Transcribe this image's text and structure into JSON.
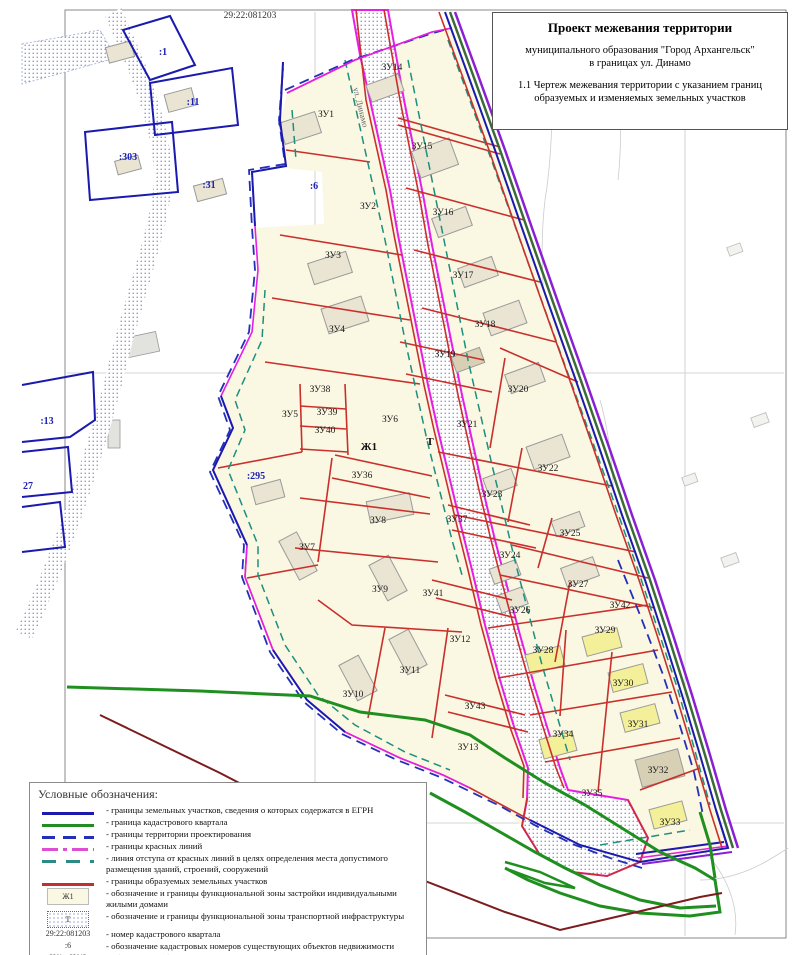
{
  "title_block": {
    "line1": "Проект межевания территории",
    "line2": "муниципального образования \"Город Архангельск\"",
    "line3": "в границах ул. Динамо",
    "line4": "1.1 Чертеж межевания территории с указанием границ образуемых и изменяемых земельных участков"
  },
  "map": {
    "quarter_number": "29:22:081203",
    "street_label": "ул. Динамо",
    "zone_labels": [
      {
        "t": "Ж1",
        "x": 369,
        "y": 450
      },
      {
        "t": "Т",
        "x": 430,
        "y": 445
      }
    ],
    "plot_labels": [
      {
        "t": "ЗУ1",
        "x": 326,
        "y": 117
      },
      {
        "t": "ЗУ2",
        "x": 368,
        "y": 209
      },
      {
        "t": "ЗУ3",
        "x": 333,
        "y": 258
      },
      {
        "t": "ЗУ4",
        "x": 337,
        "y": 332
      },
      {
        "t": "ЗУ5",
        "x": 290,
        "y": 417
      },
      {
        "t": "ЗУ6",
        "x": 390,
        "y": 422
      },
      {
        "t": "ЗУ7",
        "x": 307,
        "y": 550
      },
      {
        "t": "ЗУ8",
        "x": 378,
        "y": 523
      },
      {
        "t": "ЗУ9",
        "x": 380,
        "y": 592
      },
      {
        "t": "ЗУ10",
        "x": 353,
        "y": 697
      },
      {
        "t": "ЗУ11",
        "x": 410,
        "y": 673
      },
      {
        "t": "ЗУ12",
        "x": 460,
        "y": 642
      },
      {
        "t": "ЗУ13",
        "x": 468,
        "y": 750
      },
      {
        "t": "ЗУ14",
        "x": 392,
        "y": 70
      },
      {
        "t": "ЗУ15",
        "x": 422,
        "y": 149
      },
      {
        "t": "ЗУ16",
        "x": 443,
        "y": 215
      },
      {
        "t": "ЗУ17",
        "x": 463,
        "y": 278
      },
      {
        "t": "ЗУ18",
        "x": 485,
        "y": 327
      },
      {
        "t": "ЗУ19",
        "x": 445,
        "y": 357
      },
      {
        "t": "ЗУ20",
        "x": 518,
        "y": 392
      },
      {
        "t": "ЗУ21",
        "x": 467,
        "y": 427
      },
      {
        "t": "ЗУ22",
        "x": 548,
        "y": 471
      },
      {
        "t": "ЗУ23",
        "x": 492,
        "y": 497
      },
      {
        "t": "ЗУ24",
        "x": 510,
        "y": 558
      },
      {
        "t": "ЗУ25",
        "x": 570,
        "y": 536
      },
      {
        "t": "ЗУ26",
        "x": 520,
        "y": 613
      },
      {
        "t": "ЗУ27",
        "x": 578,
        "y": 587
      },
      {
        "t": "ЗУ28",
        "x": 543,
        "y": 653
      },
      {
        "t": "ЗУ29",
        "x": 605,
        "y": 633
      },
      {
        "t": "ЗУ30",
        "x": 623,
        "y": 686
      },
      {
        "t": "ЗУ31",
        "x": 638,
        "y": 727
      },
      {
        "t": "ЗУ32",
        "x": 658,
        "y": 773
      },
      {
        "t": "ЗУ33",
        "x": 670,
        "y": 825
      },
      {
        "t": "ЗУ34",
        "x": 563,
        "y": 737
      },
      {
        "t": "ЗУ35",
        "x": 592,
        "y": 796
      },
      {
        "t": "ЗУ36",
        "x": 362,
        "y": 478
      },
      {
        "t": "ЗУ37",
        "x": 457,
        "y": 522
      },
      {
        "t": "ЗУ38",
        "x": 320,
        "y": 392
      },
      {
        "t": "ЗУ39",
        "x": 327,
        "y": 415
      },
      {
        "t": "ЗУ40",
        "x": 325,
        "y": 433
      },
      {
        "t": "ЗУ41",
        "x": 433,
        "y": 596
      },
      {
        "t": "ЗУ42",
        "x": 620,
        "y": 608
      },
      {
        "t": "ЗУ43",
        "x": 475,
        "y": 709
      }
    ],
    "cadastral_labels": [
      {
        "t": ":1",
        "x": 163,
        "y": 55
      },
      {
        "t": ":11",
        "x": 193,
        "y": 105
      },
      {
        "t": ":303",
        "x": 128,
        "y": 160
      },
      {
        "t": ":31",
        "x": 209,
        "y": 188
      },
      {
        "t": ":13",
        "x": 47,
        "y": 424
      },
      {
        "t": "27",
        "x": 28,
        "y": 489
      },
      {
        "t": ":295",
        "x": 256,
        "y": 479
      },
      {
        "t": ":6",
        "x": 314,
        "y": 189
      }
    ]
  },
  "legend": {
    "title": "Условные обозначения:",
    "items": [
      {
        "swatch": "line-egrn",
        "label": "- границы земельных участков, сведения о которых содержатся в ЕГРН"
      },
      {
        "swatch": "line-quarter",
        "label": "- граница кадастрового квартала"
      },
      {
        "swatch": "line-project",
        "label": "- границы территории проектирования"
      },
      {
        "swatch": "line-redline",
        "label": "- границы красных линий"
      },
      {
        "swatch": "line-setback",
        "label": "- линия отступа от красных линий в целях определения места допустимого размещения зданий, строений, сооружений"
      },
      {
        "swatch": "line-formed",
        "label": "- границы образуемых земельных участков"
      },
      {
        "swatch": "box-zh1",
        "swatch_text": "Ж1",
        "label": "- обозначение и границы функциональной зоны застройки индивидуальными жилыми домами"
      },
      {
        "swatch": "box-t",
        "swatch_text": "Т",
        "label": "- обозначение и границы функциональной зоны транспортной инфраструктуры"
      },
      {
        "swatch": "sw-text",
        "swatch_text": "29:22:081203",
        "label": "- номер кадастрового квартала"
      },
      {
        "swatch": "sw-text",
        "swatch_text": ":6",
        "label": "- обозначение кадастровых номеров существующих объектов недвижимости"
      },
      {
        "swatch": "sw-text",
        "swatch_text": "ЗУ1 - ЗУ43",
        "label": "- обозначение образуемых земельных участков"
      }
    ]
  },
  "colors": {
    "egrn_blue": "#1A1AAE",
    "quarter_green": "#238C23",
    "project_blue": "#2530B8",
    "red_line_magenta": "#E61EE6",
    "setback_teal": "#1C8F7E",
    "formed_red": "#C9302C",
    "residential_zone": "#FAF7E2",
    "transport_dots": "#4656A8",
    "dark_red": "#7C1C1C",
    "purple": "#8A1FD4"
  }
}
